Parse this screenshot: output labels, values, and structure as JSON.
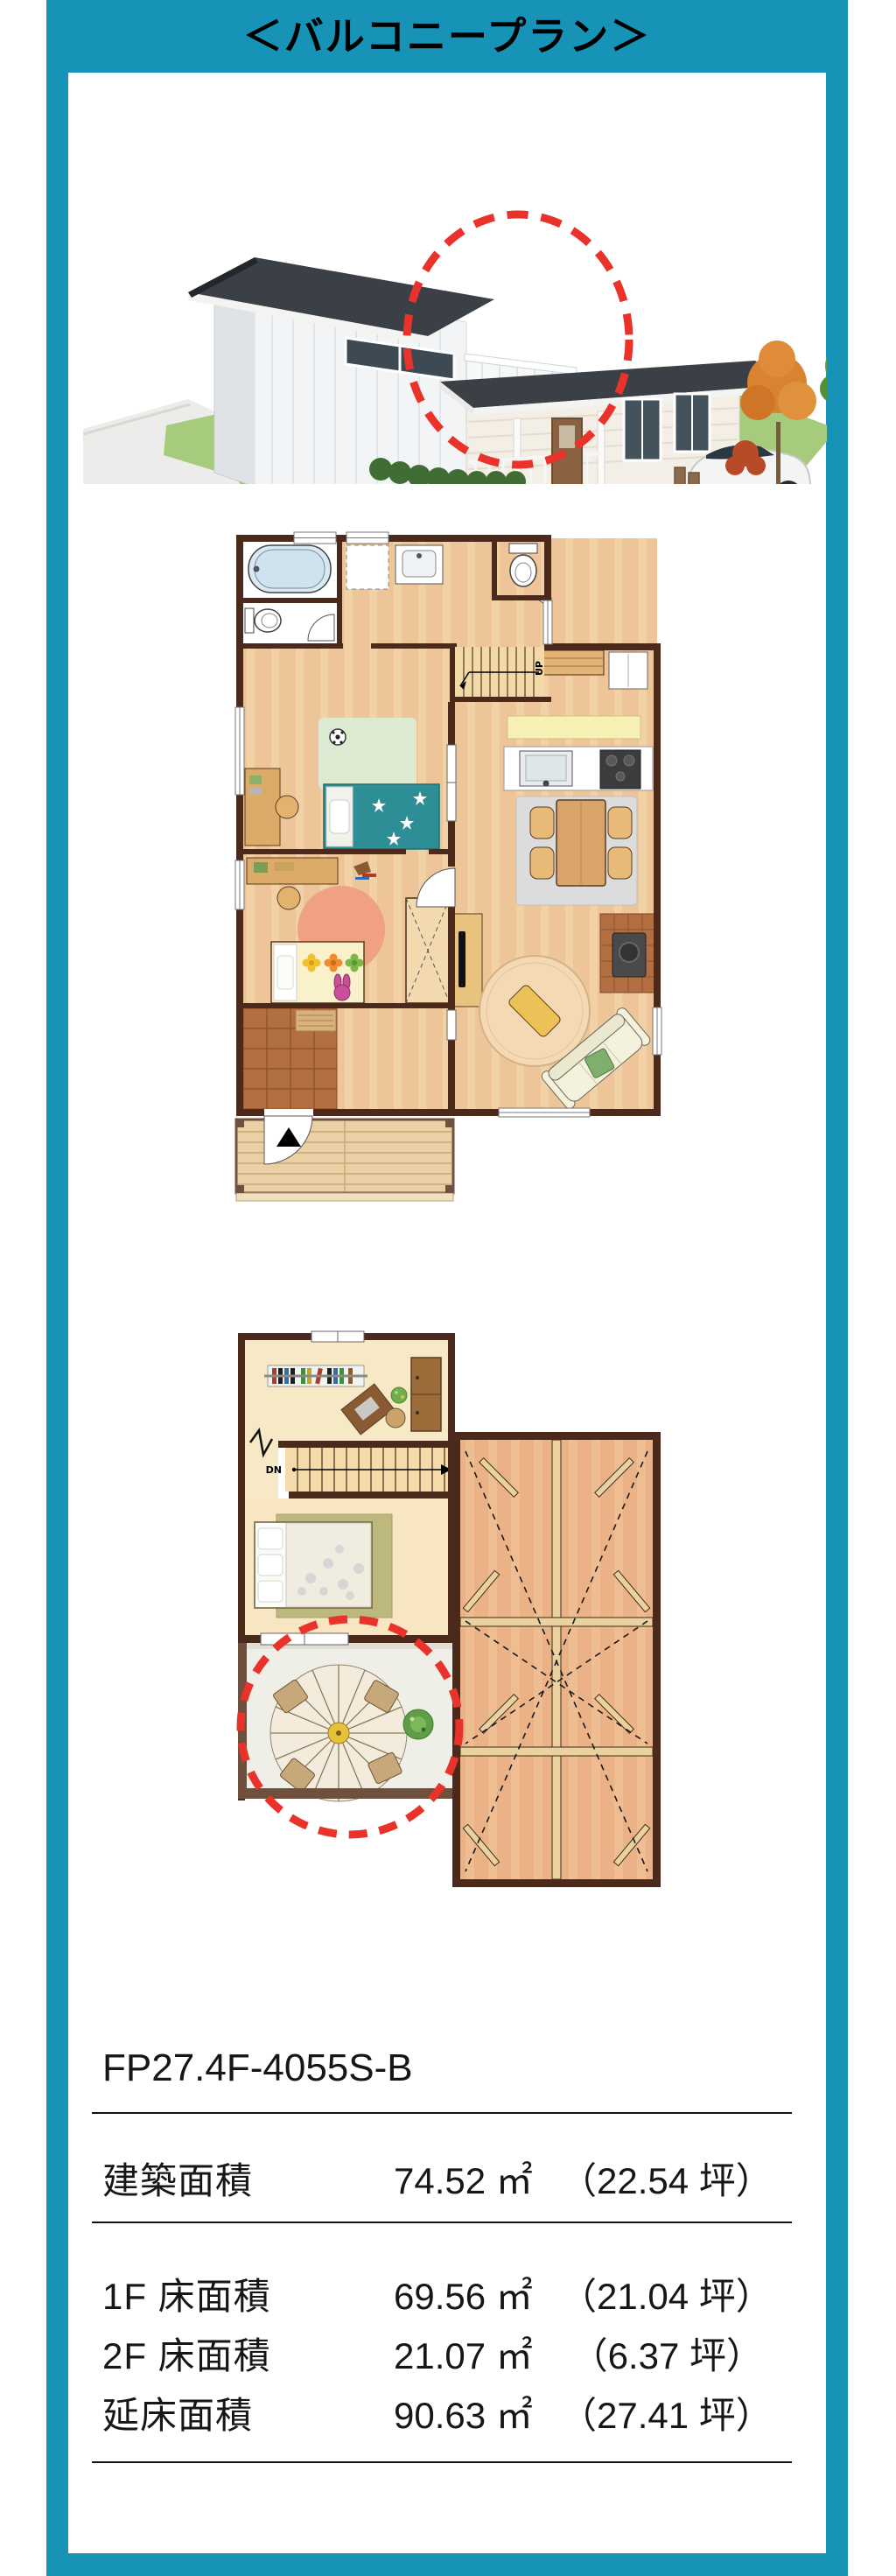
{
  "header": {
    "title": "＜バルコニープラン＞"
  },
  "colors": {
    "frame_teal": "#1793b8",
    "highlight_red": "#e8322a",
    "wall_brown": "#4b2a1b"
  },
  "house_render": {
    "type": "3d-exterior-house-illustration",
    "highlight": "balcony-circled-red-dashed"
  },
  "plans": {
    "first_floor": {
      "stair_label": "UP"
    },
    "second_floor": {
      "stair_label": "DN",
      "highlight": "balcony-circled-red-dashed"
    }
  },
  "specs": {
    "plan_code": "FP27.4F-4055S-B",
    "rows": [
      {
        "label": "建築面積",
        "sqm": "74.52 ㎡",
        "tsubo": "（22.54 坪）"
      },
      {
        "label": "1F 床面積",
        "sqm": "69.56 ㎡",
        "tsubo": "（21.04 坪）"
      },
      {
        "label": "2F 床面積",
        "sqm": "21.07 ㎡",
        "tsubo": "（6.37 坪）"
      },
      {
        "label": "延床面積",
        "sqm": "90.63 ㎡",
        "tsubo": "（27.41 坪）"
      }
    ]
  }
}
